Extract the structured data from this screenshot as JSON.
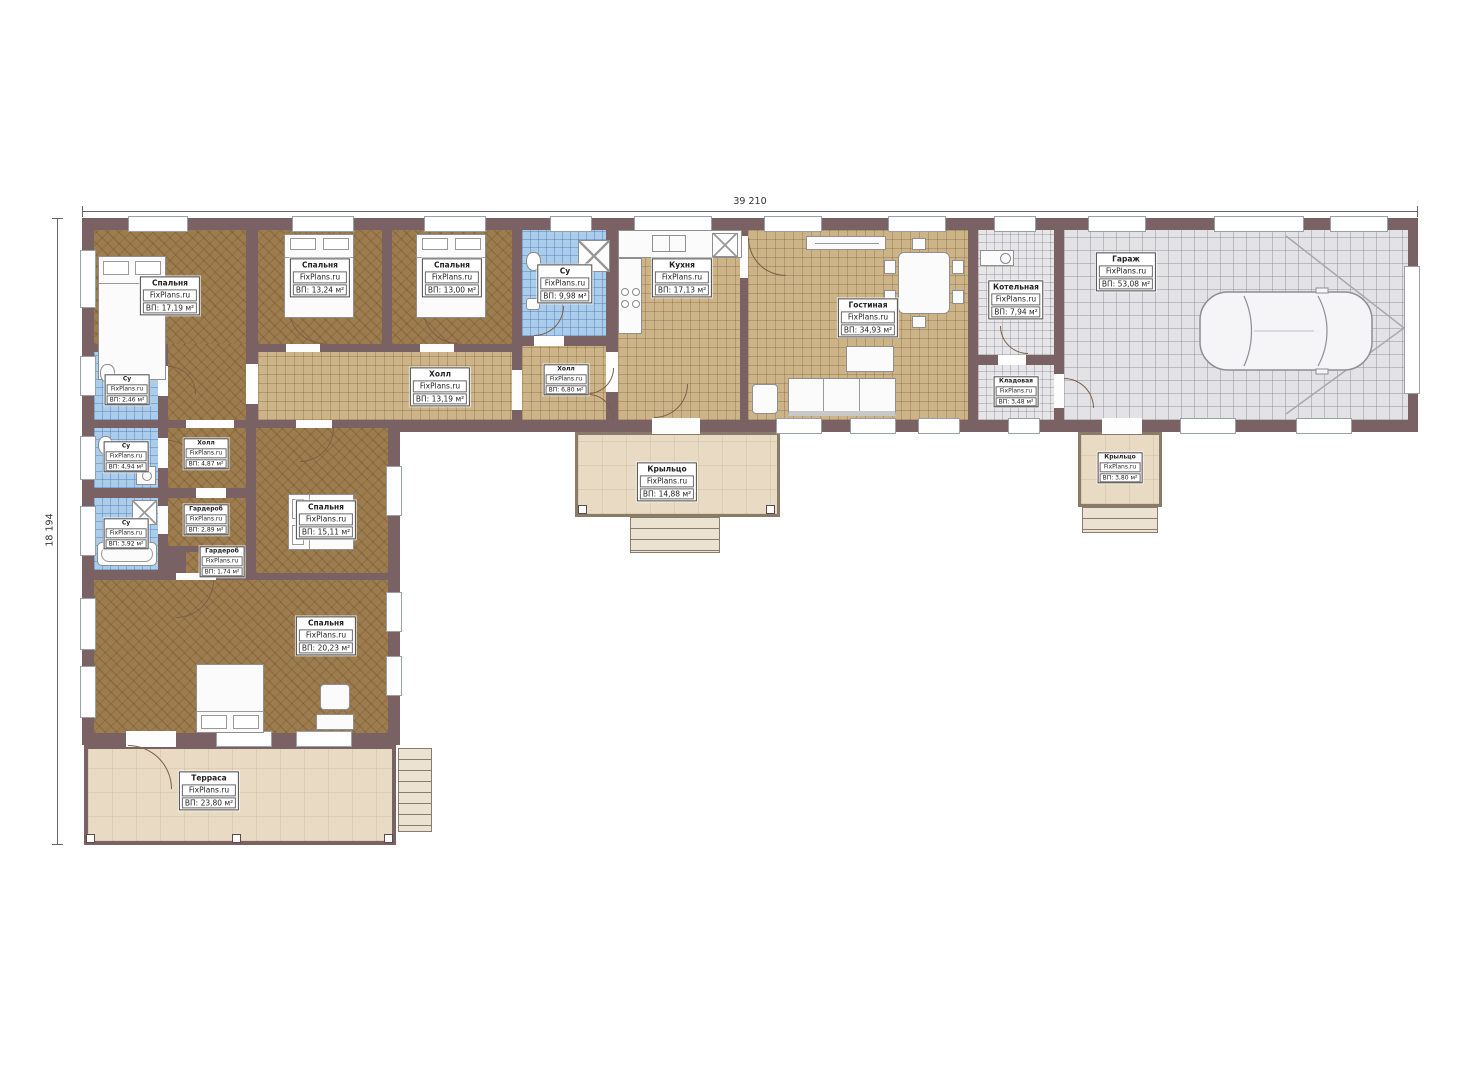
{
  "title": "План одноэтажного дома",
  "brand": "FixPlans.ru",
  "dimensions": {
    "top": "39 210",
    "left": "18 194"
  },
  "colors": {
    "wall": "#7a6264",
    "wood_floor": "#9d7d4f",
    "tile_floor": "#ccb488",
    "bath_tile": "#abcdec",
    "garage_tile": "#e3e3e5",
    "terrace": "#e9dbc3"
  },
  "rooms": {
    "bedroom1": {
      "name": "Спальня",
      "area": "ВП: 17,19 м²"
    },
    "bedroom2": {
      "name": "Спальня",
      "area": "ВП: 13,24 м²"
    },
    "bedroom3": {
      "name": "Спальня",
      "area": "ВП: 13,00 м²"
    },
    "su1": {
      "name": "Су",
      "area": "ВП: 2,46 м²"
    },
    "hall_main": {
      "name": "Холл",
      "area": "ВП: 13,19 м²"
    },
    "su2": {
      "name": "Су",
      "area": "ВП: 9,98 м²"
    },
    "hall2": {
      "name": "Холл",
      "area": "ВП: 6,80 м²"
    },
    "kitchen": {
      "name": "Кухня",
      "area": "ВП: 17,13 м²"
    },
    "living": {
      "name": "Гостиная",
      "area": "ВП: 34,93 м²"
    },
    "boiler": {
      "name": "Котельная",
      "area": "ВП: 7,94 м²"
    },
    "storage": {
      "name": "Кладовая",
      "area": "ВП: 3,48 м²"
    },
    "garage": {
      "name": "Гараж",
      "area": "ВП: 53,08 м²"
    },
    "su3": {
      "name": "Су",
      "area": "ВП: 4,94 м²"
    },
    "hall3": {
      "name": "Холл",
      "area": "ВП: 4,87 м²"
    },
    "su4": {
      "name": "Су",
      "area": "ВП: 3,92 м²"
    },
    "wardrobe1": {
      "name": "Гардероб",
      "area": "ВП: 2,89 м²"
    },
    "wardrobe2": {
      "name": "Гардероб",
      "area": "ВП: 1,74 м²"
    },
    "bedroom4": {
      "name": "Спальня",
      "area": "ВП: 15,11 м²"
    },
    "bedroom5": {
      "name": "Спальня",
      "area": "ВП: 20,23 м²"
    },
    "terrace": {
      "name": "Терраса",
      "area": "ВП: 23,80 м²"
    },
    "porch1": {
      "name": "Крыльцо",
      "area": "ВП: 14,88 м²"
    },
    "porch2": {
      "name": "Крыльцо",
      "area": "ВП: 3,80 м²"
    }
  }
}
